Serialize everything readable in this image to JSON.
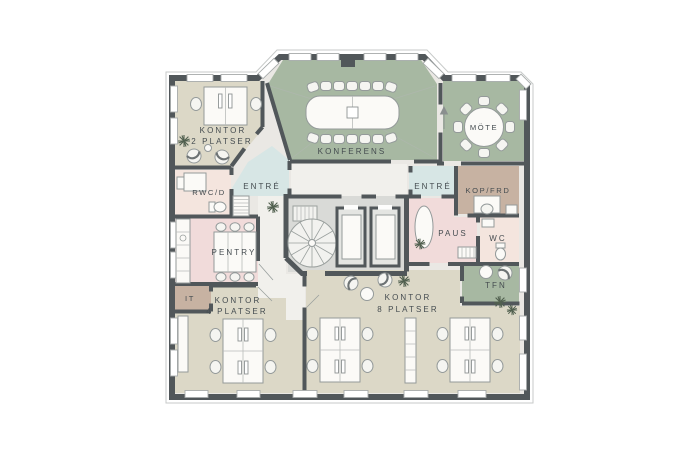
{
  "plan": {
    "type": "office-floor-plan",
    "language": "sv",
    "rooms": {
      "kontor2": {
        "name": "KONTOR",
        "size": "2 PLATSER"
      },
      "konferens": {
        "name": "KONFERENS"
      },
      "mote": {
        "name": "MÖTE"
      },
      "entre_left": {
        "name": "ENTRÉ"
      },
      "entre_right": {
        "name": "ENTRÉ"
      },
      "rwcd": {
        "name": "RWC/D"
      },
      "pentry": {
        "name": "PENTRY"
      },
      "it": {
        "name": "IT"
      },
      "kontor4": {
        "name": "KONTOR",
        "size": "4 PLATSER"
      },
      "kontor8": {
        "name": "KONTOR",
        "size": "8 PLATSER"
      },
      "kopfrd": {
        "name": "KOP/FRD"
      },
      "paus": {
        "name": "PAUS"
      },
      "wc": {
        "name": "WC"
      },
      "tfn": {
        "name": "TFN"
      }
    },
    "colors": {
      "wall": "#51575a",
      "office_floor": "#dcd8c7",
      "meeting_green": "#a7b8a2",
      "kitchen_pink": "#f1dbda",
      "hygiene_pale": "#f4e5de",
      "entrance_blue": "#d7e6e5",
      "storage_taupe": "#c7b2a2",
      "core_gray": "#d9dad7",
      "corridor": "#f1f0ec",
      "window": "#ffffff",
      "label_text": "#454c50",
      "plant_green": "#51604f",
      "background": "#ffffff"
    },
    "icons": {
      "plant": "radiating-lines-plant",
      "spiral_stair": "circle-with-radial-steps",
      "straight_stair": "rect-with-rungs",
      "elevator": "shaft-with-car",
      "door_arrow": "up-arrow"
    }
  }
}
